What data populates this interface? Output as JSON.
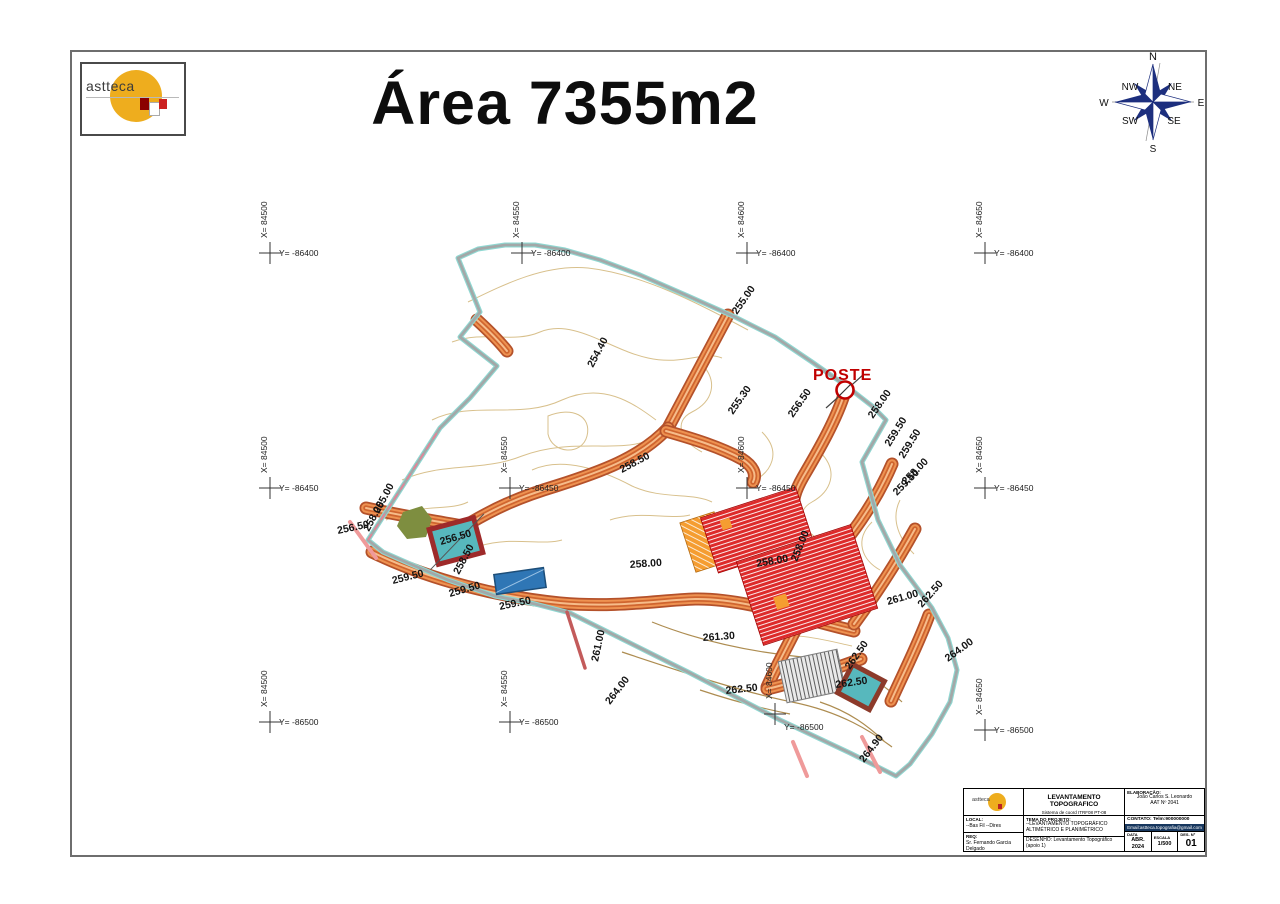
{
  "sheet": {
    "title": "Área 7355m2"
  },
  "logo": {
    "text": "astteca"
  },
  "compass": {
    "n": "N",
    "ne": "NE",
    "e": "E",
    "se": "SE",
    "s": "S",
    "sw": "SW",
    "w": "W",
    "nw": "NW"
  },
  "grid": {
    "crosses": [
      {
        "x": "X= 84500",
        "y": "Y= -86400"
      },
      {
        "x": "X= 84550",
        "y": "Y= -86400"
      },
      {
        "x": "X= 84600",
        "y": "Y= -86400"
      },
      {
        "x": "X= 84650",
        "y": "Y= -86400"
      },
      {
        "x": "X= 84500",
        "y": "Y= -86450"
      },
      {
        "x": "X= 84550",
        "y": "Y= -86450"
      },
      {
        "x": "X= 84600",
        "y": "Y= -86450"
      },
      {
        "x": "X= 84650",
        "y": "Y= -86450"
      },
      {
        "x": "X= 84500",
        "y": "Y= -86500"
      },
      {
        "x": "X= 84550",
        "y": "Y= -86500"
      },
      {
        "x": "X= 84600",
        "y": "Y= -86500"
      },
      {
        "x": "X= 84650",
        "y": "Y= -86500"
      }
    ]
  },
  "map": {
    "poste_label": "POSTE",
    "labels": [
      "254.40",
      "255.00",
      "255.30",
      "256.50",
      "258.00",
      "255.00",
      "256.50",
      "258.50",
      "258.50",
      "256.50",
      "258.00",
      "259.50",
      "259.50",
      "258.00",
      "259.50",
      "258.00",
      "259.50",
      "259.50",
      "259.50",
      "258.00",
      "258.00",
      "261.00",
      "261.30",
      "261.00",
      "262.50",
      "262.50",
      "262.50",
      "262.50",
      "264.00",
      "264.00",
      "264.90"
    ]
  },
  "titleblock": {
    "logo_text": "astteca",
    "title": "LEVANTAMENTO TOPOGRAFICO",
    "subtitle": "Sistema de coord ITRF08 PT-08",
    "elab_header": "ELABORAÇÃO:",
    "elab_name": "João Carlos S. Leonardo",
    "elab_reg": "AAT Nº 2041",
    "local_header": "LOCAL:",
    "local": "--Bas Fil  --Dires",
    "req_header": "REQ:",
    "req": "Sr. Fernando Garcia Delgado",
    "tema_header": "TEMA DO PROJETO:",
    "tema": "--LEVANTAMENTO TOPOGRÁFICO ALTIMÉTRICO E PLANIMÉTRICO",
    "contato": "CONTATO:  Telm:900000000",
    "email": "Email:astteca.topografia@gmail.com",
    "desenho": "DESENHO:  Levantamento Topográfico (apoio 1)",
    "data_label": "DATA",
    "data_value": "ABR. 2024",
    "escala_label": "ESCALA",
    "escala_value": "1/500",
    "des_label": "DES. Nº",
    "des_value": "01"
  }
}
